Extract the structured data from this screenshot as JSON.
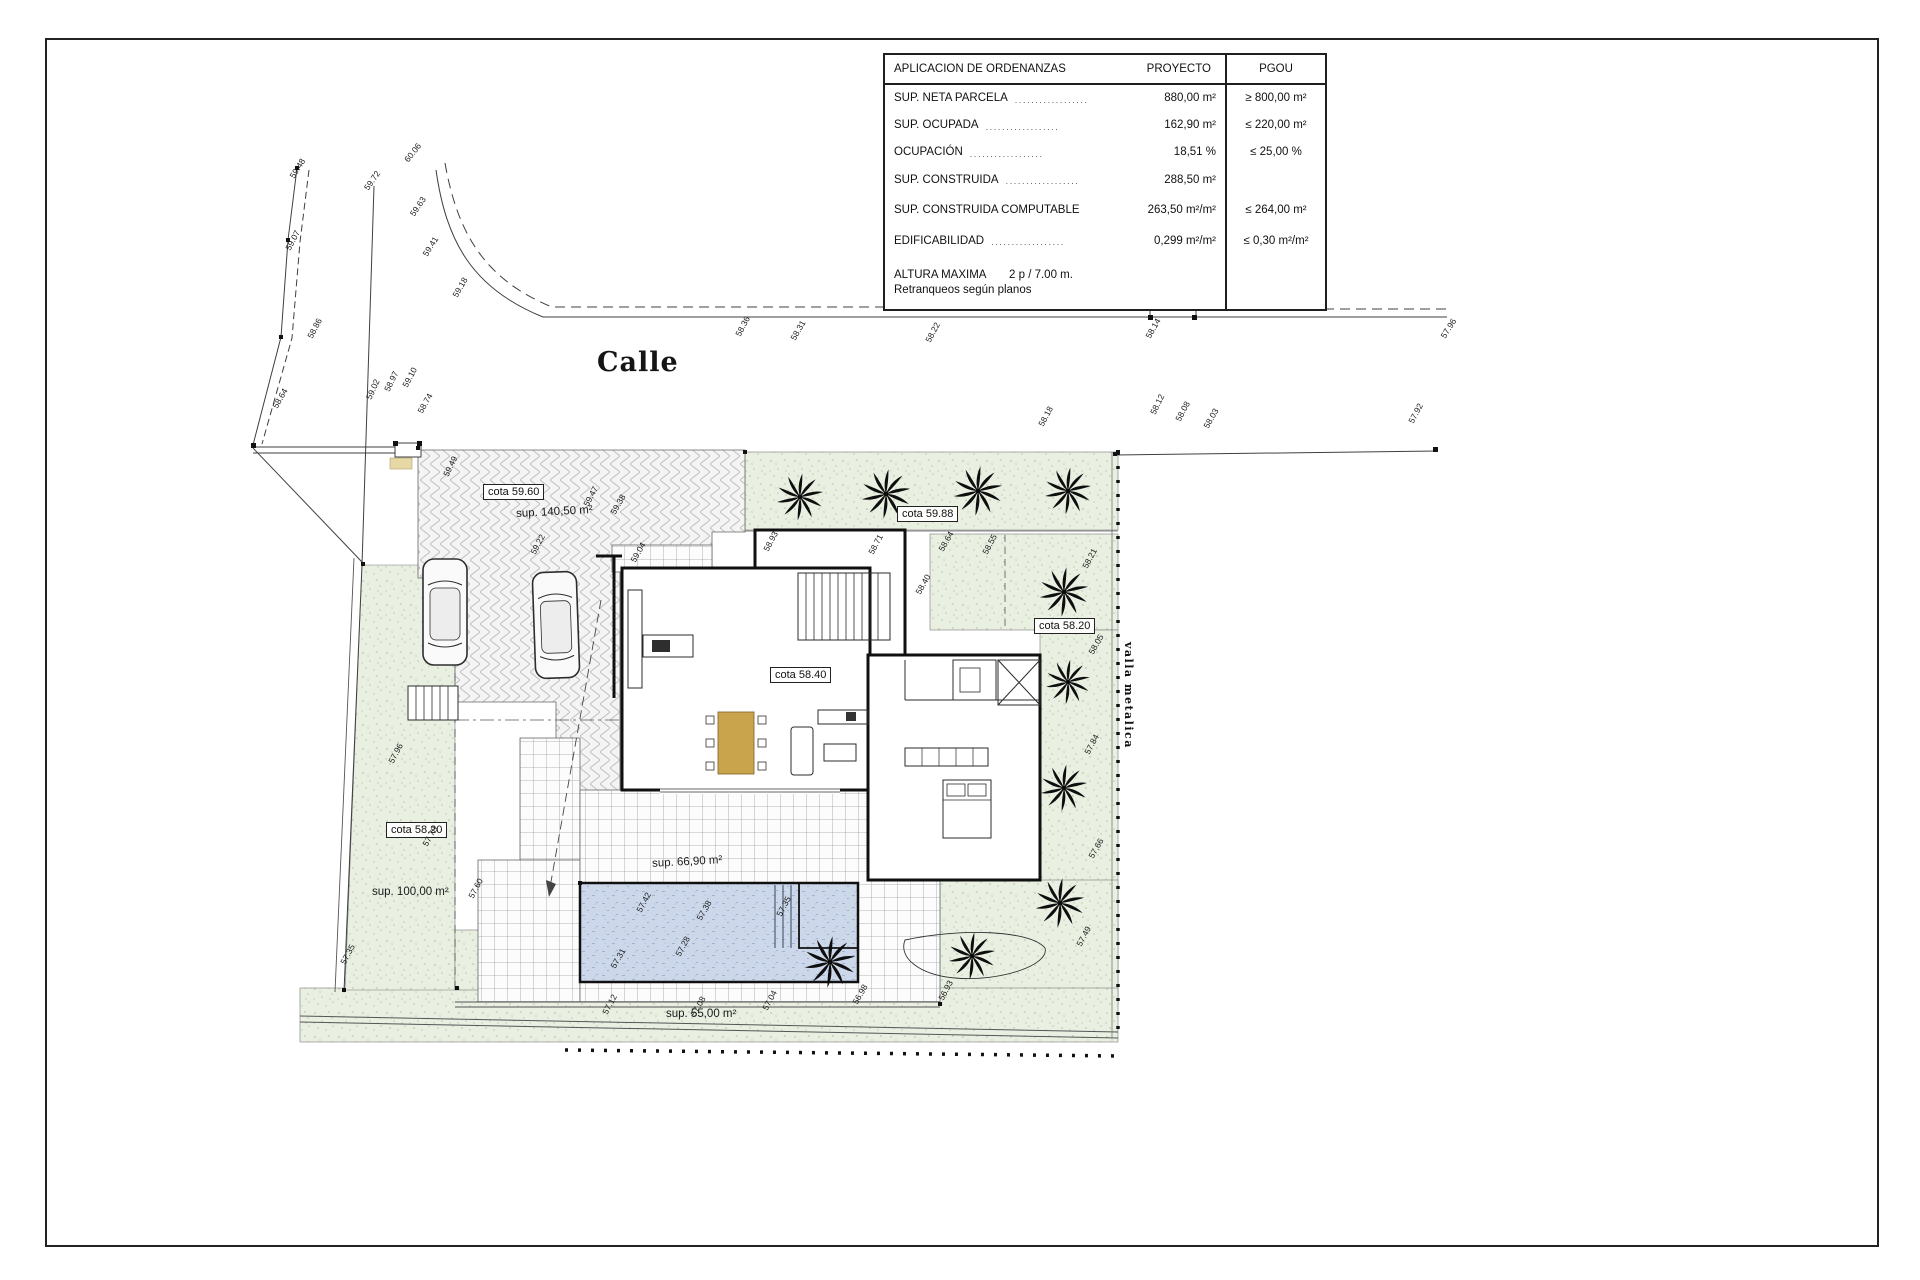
{
  "page": {
    "background": "#ffffff",
    "frame_color": "#222222"
  },
  "ordinance_table": {
    "title": "APLICACION DE ORDENANZAS",
    "col_proyecto": "PROYECTO",
    "col_pgou": "PGOU",
    "rows": [
      {
        "label": "SUP. NETA PARCELA",
        "dots": "..................",
        "proyecto": "880,00 m²",
        "pgou": "≥ 800,00 m²"
      },
      {
        "label": "SUP. OCUPADA",
        "dots": "..................",
        "proyecto": "162,90 m²",
        "pgou": "≤ 220,00 m²"
      },
      {
        "label": "OCUPACIÓN",
        "dots": "..................",
        "proyecto": "18,51 %",
        "pgou": "≤ 25,00 %"
      },
      {
        "label": "SUP. CONSTRUIDA",
        "dots": "..................",
        "proyecto": "288,50 m²",
        "pgou": ""
      },
      {
        "label": "SUP. CONSTRUIDA COMPUTABLE",
        "dots": "",
        "proyecto": "263,50 m²/m²",
        "pgou": "≤ 264,00 m²"
      },
      {
        "label": "EDIFICABILIDAD",
        "dots": "..................",
        "proyecto": "0,299 m²/m²",
        "pgou": "≤ 0,30 m²/m²"
      }
    ],
    "altura_label": "ALTURA MAXIMA",
    "altura_value": "2 p / 7.00 m.",
    "altura_note": "Retranqueos según planos"
  },
  "plan_labels": {
    "street_name": "Calle",
    "cota_driveway": "cota 59.60",
    "sup_driveway": "sup. 140,50 m²",
    "cota_garden_north": "cota 59.88",
    "cota_garden_east": "cota 58.20",
    "cota_house": "cota 58.40",
    "cota_garden_west": "cota 58.20",
    "sup_garden_west": "sup. 100,00 m²",
    "sup_pool_terrace": "sup. 66,90 m²",
    "sup_garden_south": "sup. 55,00 m²",
    "fence_label": "valla metalica"
  },
  "colors": {
    "garden_green": "#e9f0e2",
    "pool_blue": "#ccd8ea",
    "hatch_gray": "#bfbfbf",
    "grid_gray": "#989ea3",
    "wall_black": "#101010",
    "table_tan": "#c9a44c"
  },
  "spot_elevations": [
    {
      "x": 296,
      "y": 170,
      "r": -58,
      "v": "59.48"
    },
    {
      "x": 292,
      "y": 242,
      "r": -62,
      "v": "59.07"
    },
    {
      "x": 314,
      "y": 330,
      "r": -62,
      "v": "58.86"
    },
    {
      "x": 279,
      "y": 400,
      "r": -60,
      "v": "58.64"
    },
    {
      "x": 370,
      "y": 182,
      "r": -55,
      "v": "59.72"
    },
    {
      "x": 410,
      "y": 154,
      "r": -52,
      "v": "60.06"
    },
    {
      "x": 416,
      "y": 208,
      "r": -56,
      "v": "59.63"
    },
    {
      "x": 429,
      "y": 248,
      "r": -58,
      "v": "59.41"
    },
    {
      "x": 459,
      "y": 289,
      "r": -60,
      "v": "59.18"
    },
    {
      "x": 391,
      "y": 383,
      "r": -64,
      "v": "58.97"
    },
    {
      "x": 409,
      "y": 379,
      "r": -62,
      "v": "59.10"
    },
    {
      "x": 424,
      "y": 405,
      "r": -60,
      "v": "58.74"
    },
    {
      "x": 373,
      "y": 391,
      "r": -66,
      "v": "59.02"
    },
    {
      "x": 742,
      "y": 328,
      "r": -62,
      "v": "58.36"
    },
    {
      "x": 797,
      "y": 332,
      "r": -60,
      "v": "58.31"
    },
    {
      "x": 932,
      "y": 334,
      "r": -62,
      "v": "58.22"
    },
    {
      "x": 1045,
      "y": 418,
      "r": -62,
      "v": "58.18"
    },
    {
      "x": 1157,
      "y": 406,
      "r": -64,
      "v": "58.12"
    },
    {
      "x": 1182,
      "y": 413,
      "r": -62,
      "v": "58.08"
    },
    {
      "x": 1210,
      "y": 420,
      "r": -60,
      "v": "58.03"
    },
    {
      "x": 1415,
      "y": 415,
      "r": -62,
      "v": "57.92"
    },
    {
      "x": 1152,
      "y": 330,
      "r": -60,
      "v": "58.14"
    },
    {
      "x": 1447,
      "y": 330,
      "r": -58,
      "v": "57.96"
    },
    {
      "x": 450,
      "y": 468,
      "r": -64,
      "v": "59.49"
    },
    {
      "x": 590,
      "y": 498,
      "r": -62,
      "v": "59.47"
    },
    {
      "x": 617,
      "y": 506,
      "r": -60,
      "v": "59.38"
    },
    {
      "x": 537,
      "y": 546,
      "r": -62,
      "v": "59.22"
    },
    {
      "x": 637,
      "y": 554,
      "r": -60,
      "v": "59.04"
    },
    {
      "x": 770,
      "y": 543,
      "r": -62,
      "v": "58.93"
    },
    {
      "x": 875,
      "y": 546,
      "r": -62,
      "v": "58.71"
    },
    {
      "x": 945,
      "y": 543,
      "r": -60,
      "v": "58.64"
    },
    {
      "x": 989,
      "y": 546,
      "r": -62,
      "v": "58.55"
    },
    {
      "x": 922,
      "y": 586,
      "r": -60,
      "v": "58.40"
    },
    {
      "x": 1089,
      "y": 560,
      "r": -62,
      "v": "58.21"
    },
    {
      "x": 1095,
      "y": 646,
      "r": -60,
      "v": "58.05"
    },
    {
      "x": 1091,
      "y": 746,
      "r": -62,
      "v": "57.84"
    },
    {
      "x": 1095,
      "y": 850,
      "r": -60,
      "v": "57.66"
    },
    {
      "x": 1083,
      "y": 938,
      "r": -62,
      "v": "57.49"
    },
    {
      "x": 643,
      "y": 904,
      "r": -62,
      "v": "57.42"
    },
    {
      "x": 703,
      "y": 912,
      "r": -60,
      "v": "57.38"
    },
    {
      "x": 783,
      "y": 908,
      "r": -62,
      "v": "57.35"
    },
    {
      "x": 617,
      "y": 960,
      "r": -60,
      "v": "57.31"
    },
    {
      "x": 682,
      "y": 948,
      "r": -62,
      "v": "57.28"
    },
    {
      "x": 395,
      "y": 755,
      "r": -62,
      "v": "57.96"
    },
    {
      "x": 429,
      "y": 838,
      "r": -60,
      "v": "57.78"
    },
    {
      "x": 475,
      "y": 890,
      "r": -62,
      "v": "57.60"
    },
    {
      "x": 609,
      "y": 1006,
      "r": -62,
      "v": "57.12"
    },
    {
      "x": 697,
      "y": 1008,
      "r": -60,
      "v": "57.08"
    },
    {
      "x": 769,
      "y": 1002,
      "r": -62,
      "v": "57.04"
    },
    {
      "x": 859,
      "y": 996,
      "r": -60,
      "v": "56.98"
    },
    {
      "x": 945,
      "y": 992,
      "r": -62,
      "v": "56.93"
    },
    {
      "x": 347,
      "y": 956,
      "r": -62,
      "v": "57.35"
    }
  ],
  "palms": [
    {
      "x": 800,
      "y": 497,
      "s": 1.0
    },
    {
      "x": 886,
      "y": 494,
      "s": 1.05
    },
    {
      "x": 978,
      "y": 491,
      "s": 1.05
    },
    {
      "x": 1068,
      "y": 491,
      "s": 1.0
    },
    {
      "x": 1064,
      "y": 592,
      "s": 1.05
    },
    {
      "x": 1068,
      "y": 682,
      "s": 0.95
    },
    {
      "x": 1064,
      "y": 788,
      "s": 1.0
    },
    {
      "x": 1060,
      "y": 903,
      "s": 1.05
    },
    {
      "x": 972,
      "y": 956,
      "s": 1.0
    },
    {
      "x": 830,
      "y": 962,
      "s": 1.1
    }
  ]
}
